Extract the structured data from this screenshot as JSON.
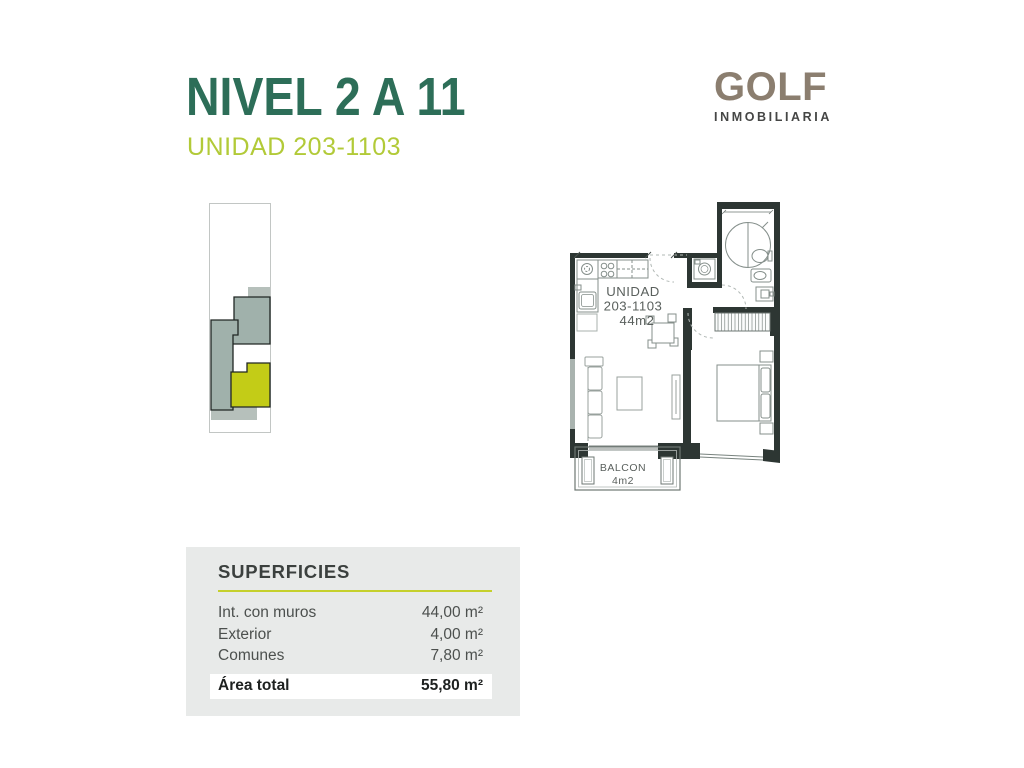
{
  "page": {
    "title": "NIVEL 2 A 11",
    "subtitle": "UNIDAD 203-1103"
  },
  "logo": {
    "name": "GOLF",
    "tagline": "INMOBILIARIA"
  },
  "floor_plan": {
    "unit_label_line1": "UNIDAD",
    "unit_label_line2": "203-1103",
    "unit_label_line3": "44m2",
    "balcony_label_line1": "BALCON",
    "balcony_label_line2": "4m2"
  },
  "superficies": {
    "heading": "SUPERFICIES",
    "rows": [
      {
        "label": "Int. con muros",
        "value": "44,00 m²"
      },
      {
        "label": "Exterior",
        "value": "4,00 m²"
      },
      {
        "label": "Comunes",
        "value": "7,80 m²"
      }
    ],
    "total": {
      "label": "Área total",
      "value": "55,80 m²"
    }
  },
  "colors": {
    "title_green": "#2d6e58",
    "accent_chartreuse": "#c5d02c",
    "subtitle_green": "#b2ca38",
    "logo_taupe": "#8b7e6f",
    "keyplan_gray": "#a0b1ab",
    "keyplan_highlight": "#c3cc17",
    "wall_dark": "#2d3633",
    "panel_bg": "#e8eae9"
  }
}
